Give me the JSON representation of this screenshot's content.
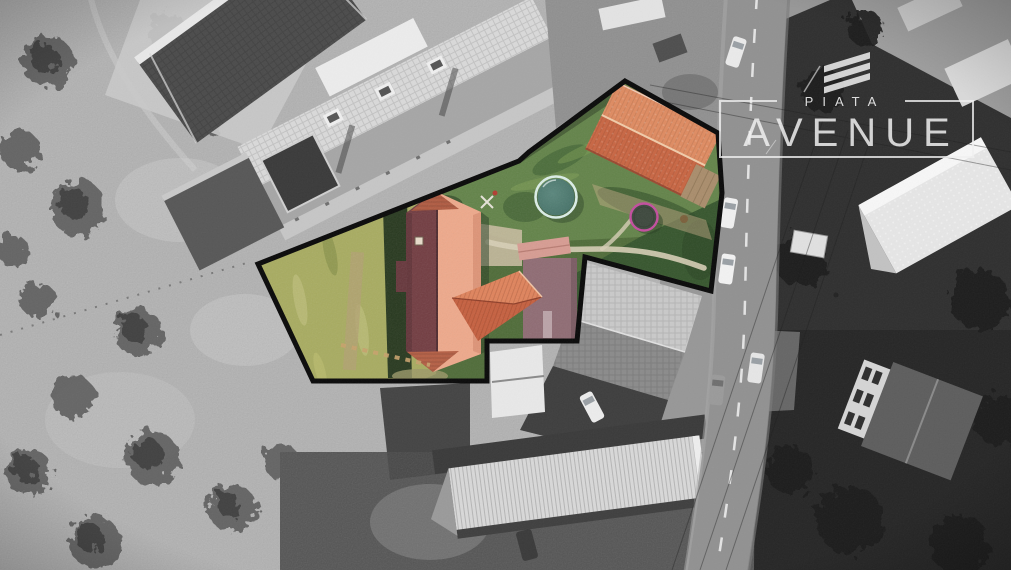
{
  "canvas": {
    "width": 1011,
    "height": 570
  },
  "logo": {
    "subtitle": "PIATA",
    "title": "AVENUE",
    "icon": "triple-chevron-icon"
  },
  "scene": {
    "kind": "aerial-drone-photo-real-estate",
    "highlight": "black-outlined-property-in-color-over-grayscale-surroundings",
    "property_features": [
      "main-house",
      "east-wing",
      "outbuilding",
      "garden-annex",
      "swimming-pool",
      "trampoline",
      "lawn",
      "rough-grass",
      "gravel-path",
      "wood-fence",
      "patio"
    ],
    "surroundings": [
      "field-with-trees",
      "neighbor-houses",
      "street-with-parked-cars",
      "warehouse",
      "power-lines"
    ]
  },
  "colors": {
    "boundary": "#0a0a0a",
    "lawn": "#4e6b37",
    "lawn_light": "#628348",
    "lawn_dark": "#33532a",
    "rough_grass": "#a8ac60",
    "roof_shadow_side": "#723c41",
    "roof_lit_side": "#efa98b",
    "wing_roof": "#c65f3e",
    "outbuilding_roof_light": "#e08a5f",
    "outbuilding_roof_dark": "#c96440",
    "annex_roof": "#8f6b73",
    "pink_shed_roof": "#d89c92",
    "pool_water": "#4b7a70",
    "pool_rim": "#dcefe9",
    "trampoline_rim": "#c44b9e",
    "trampoline_mat": "#3b463b",
    "path": "#d8cfb6",
    "road": "#919191",
    "logo": "#f0f0f0"
  }
}
